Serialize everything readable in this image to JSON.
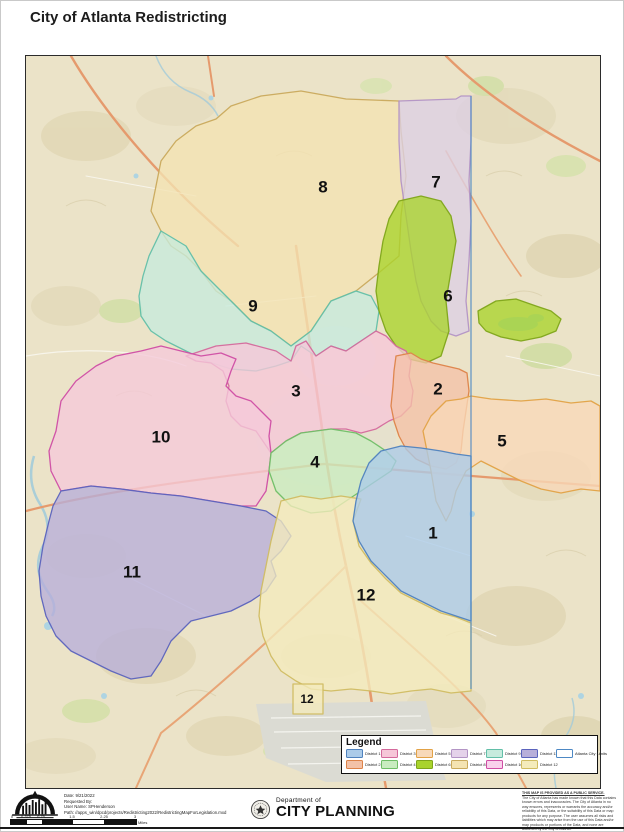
{
  "title": "City of Atlanta Redistricting",
  "map": {
    "city_limits_color": "#4d88c4",
    "districts": [
      {
        "key": "district-8",
        "num": "8",
        "fill": "#f4e3b2",
        "stroke": "#c9a95c",
        "label_x": 297,
        "label_y": 132
      },
      {
        "key": "district-7",
        "num": "7",
        "fill": "#dccfe4",
        "stroke": "#b394c5",
        "label_x": 410,
        "label_y": 127
      },
      {
        "key": "district-9",
        "num": "9",
        "fill": "#c6ebdd",
        "stroke": "#62bfa8",
        "label_x": 227,
        "label_y": 251
      },
      {
        "key": "district-6",
        "num": "6",
        "fill": "#a9d32c",
        "stroke": "#7fa51a",
        "label_x": 422,
        "label_y": 241
      },
      {
        "key": "district-3",
        "num": "3",
        "fill": "#f6c6d8",
        "stroke": "#d4699c",
        "label_x": 270,
        "label_y": 336
      },
      {
        "key": "district-10",
        "num": "10",
        "fill": "#f5c9da",
        "stroke": "#cf4da4",
        "label_x": 135,
        "label_y": 382
      },
      {
        "key": "district-2",
        "num": "2",
        "fill": "#f3c2a8",
        "stroke": "#dd8349",
        "label_x": 412,
        "label_y": 334
      },
      {
        "key": "district-5",
        "num": "5",
        "fill": "#f8d9b9",
        "stroke": "#e2a246",
        "label_x": 476,
        "label_y": 386
      },
      {
        "key": "district-4",
        "num": "4",
        "fill": "#c9ecc0",
        "stroke": "#6fbe66",
        "label_x": 289,
        "label_y": 407
      },
      {
        "key": "district-11",
        "num": "11",
        "fill": "#b7aeda",
        "stroke": "#5b63bd",
        "label_x": 106,
        "label_y": 517
      },
      {
        "key": "district-12",
        "num": "12",
        "fill": "#f4ebbc",
        "stroke": "#d0bc62",
        "label_x": 340,
        "label_y": 540
      },
      {
        "key": "district-1",
        "num": "1",
        "fill": "#abcbe9",
        "stroke": "#4f82be",
        "label_x": 407,
        "label_y": 478
      }
    ],
    "extra_labels": [
      {
        "text": "12",
        "x": 281,
        "y": 644
      }
    ]
  },
  "legend": {
    "title": "Legend",
    "rows": [
      [
        {
          "label": "District 1",
          "fill": "#abcbe9",
          "stroke": "#4f82be"
        },
        {
          "label": "District 3",
          "fill": "#f6c6d8",
          "stroke": "#d4699c"
        },
        {
          "label": "District 5",
          "fill": "#f8d9b9",
          "stroke": "#e2a246"
        },
        {
          "label": "District 7",
          "fill": "#e4d2ea",
          "stroke": "#b394c5"
        },
        {
          "label": "District 9",
          "fill": "#c6ebdd",
          "stroke": "#62bfa8"
        },
        {
          "label": "District 11",
          "fill": "#b7aeda",
          "stroke": "#5b63bd"
        },
        {
          "label": "Atlanta City Limits",
          "fill": "#ffffff",
          "stroke": "#4d88c4"
        }
      ],
      [
        {
          "label": "District 2",
          "fill": "#f3c2a8",
          "stroke": "#dd8349"
        },
        {
          "label": "District 4",
          "fill": "#c9ecc0",
          "stroke": "#6fbe66"
        },
        {
          "label": "District 6",
          "fill": "#a9d32c",
          "stroke": "#7fa51a"
        },
        {
          "label": "District 8",
          "fill": "#f4e3b2",
          "stroke": "#c9a95c"
        },
        {
          "label": "District 10",
          "fill": "#f9d2ec",
          "stroke": "#cf4da4"
        },
        {
          "label": "District 12",
          "fill": "#f4ebbc",
          "stroke": "#d0bc62"
        }
      ]
    ]
  },
  "footer": {
    "info_lines": [
      "Date: 9/21/2022",
      "Requested By:",
      "User Name: SPHenderson",
      "Path: //apps_win/dpcd/projects/Redistricting2022/RedistrictingMapForLegislation.mxd"
    ],
    "scalebar": {
      "ticks": [
        "0",
        "0.375",
        "0.75",
        "1.5",
        "2.25",
        "3"
      ],
      "unit": "Miles"
    },
    "department": {
      "line1": "Department of",
      "line2": "CITY PLANNING"
    },
    "disclaimer": {
      "heading": "THIS MAP IS PROVIDED AS A PUBLIC SERVICE.",
      "body": "The City of Atlanta has made known that this Data contains known errors and inaccuracies. The City of Atlanta in no way ensures, represents or warrants the accuracy and/or reliability of this Data, or the suitability of this Data or map products for any purpose. The user assumes all risks and liabilities which may arise from the use of this Data and/or map products or portions of the Data, and none are assumed by the City of Atlanta."
    }
  }
}
